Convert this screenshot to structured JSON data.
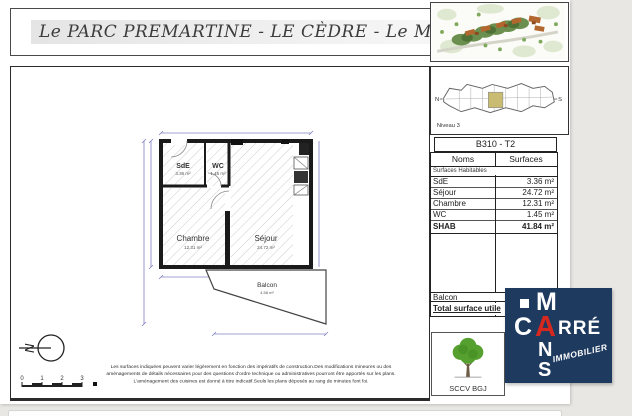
{
  "title": "Le PARC PREMARTINE - LE CÈDRE - Le Mans",
  "level_plan": {
    "label": "Niveau 3",
    "north": "N",
    "south": "S"
  },
  "unit": {
    "id": "B310 - T2"
  },
  "surface_table": {
    "col_name": "Noms",
    "col_surface": "Surfaces",
    "subheader": "Surfaces Habitables",
    "rows": [
      {
        "name": "SdE",
        "surface": "3.36 m²"
      },
      {
        "name": "Séjour",
        "surface": "24.72 m²"
      },
      {
        "name": "Chambre",
        "surface": "12.31 m²"
      },
      {
        "name": "WC",
        "surface": "1.45 m²"
      },
      {
        "name": "SHAB",
        "surface": "41.84 m²"
      }
    ],
    "balcon_label": "Balcon",
    "total_label": "Total surface utile"
  },
  "floor_plan": {
    "rooms": [
      {
        "name": "SdE",
        "area": "3.36 m²"
      },
      {
        "name": "WC",
        "area": "1.45 m²"
      },
      {
        "name": "Chambre",
        "area": "12.31 m²"
      },
      {
        "name": "Séjour",
        "area": "24.72 m²"
      },
      {
        "name": "Balcon",
        "area": "4.58 m²"
      }
    ],
    "north_letter": "N"
  },
  "scale_bar": {
    "ticks": [
      "0",
      "1",
      "2",
      "3"
    ]
  },
  "disclaimer": {
    "line1": "Les surfaces indiquées peuvent varier légèrement en fonction des impératifs de construction.Des modifications mineures ou des",
    "line2": "aménagements de détails nécessaires pour des questions d'ordre technique ou administratives pourront être apportés sur les plans.",
    "line3": "L'aménagement des cuisines est donné à titre indicatif.Seuls les plans déposés au rang de minutes font foi."
  },
  "developer": {
    "name": "SCCV BGJ"
  },
  "brand_logo": {
    "m": "M",
    "c": "C",
    "a": "A",
    "rre": "RRÉ",
    "n": "N",
    "s": "S",
    "tagline": "IMMOBILIER"
  },
  "colors": {
    "logo_navy": "#1e3a5f",
    "logo_red": "#d7281f",
    "tree_green": "#55a02e",
    "unit_highlight": "#c9bc72",
    "dimension_blue": "#8080c0",
    "canvas_bg": "#e8e7e4"
  }
}
